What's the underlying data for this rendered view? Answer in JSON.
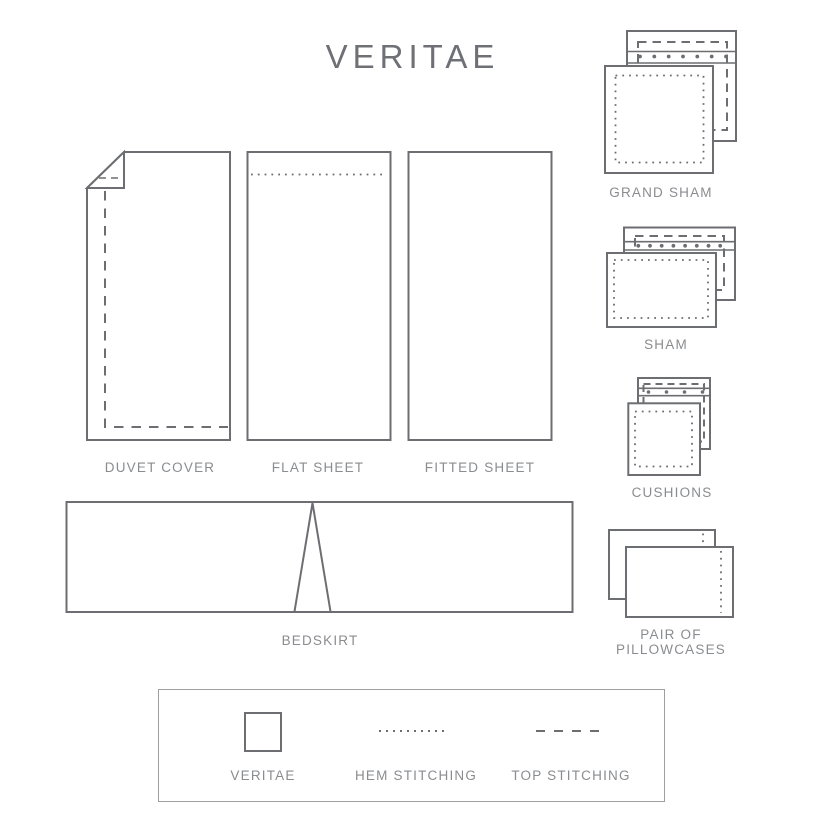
{
  "title": "VERITAE",
  "colors": {
    "outline": "#6d6e71",
    "label_text": "#8a8c8f",
    "title_text": "#6e7075",
    "legend_border": "#9d9fa2",
    "background": "#ffffff"
  },
  "products": {
    "duvet_cover": {
      "label": "DUVET COVER"
    },
    "flat_sheet": {
      "label": "FLAT SHEET"
    },
    "fitted_sheet": {
      "label": "FITTED SHEET"
    },
    "grand_sham": {
      "label": "GRAND SHAM"
    },
    "sham": {
      "label": "SHAM"
    },
    "cushions": {
      "label": "CUSHIONS"
    },
    "bedskirt": {
      "label": "BEDSKIRT"
    },
    "pillowcases": {
      "label_line1": "PAIR OF",
      "label_line2": "PILLOWCASES"
    }
  },
  "legend": {
    "items": [
      {
        "symbol": "square-outline",
        "label": "VERITAE"
      },
      {
        "symbol": "dotted-line",
        "label": "HEM STITCHING"
      },
      {
        "symbol": "dashed-line",
        "label": "TOP STITCHING"
      }
    ]
  }
}
